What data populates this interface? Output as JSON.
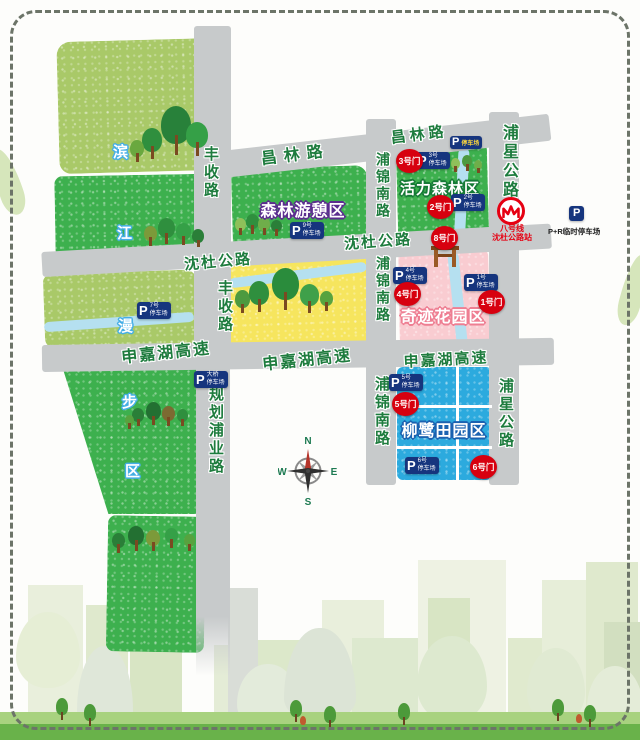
{
  "map": {
    "roads": {
      "fengshou": "丰收路",
      "changlin": "昌林路",
      "shendu": "沈杜公路",
      "shenjiahu": "申嘉湖高速",
      "pujin_south": "浦锦南路",
      "puxing": "浦星公路",
      "guihua_puye": "规划浦业路"
    },
    "zones": {
      "forest_leisure": "森林游憩区",
      "vital_forest": "活力森林区",
      "miracle_garden": "奇迹花园区",
      "willow_field": "柳鹭田园区"
    },
    "zone_chars": {
      "c1": "滨",
      "c2": "江",
      "c3": "漫",
      "c4": "步",
      "c5": "区"
    },
    "gates": {
      "g1": "1号门",
      "g2": "2号门",
      "g3": "3号门",
      "g4": "4号门",
      "g5": "5号门",
      "g6": "6号门",
      "g8": "8号门"
    },
    "parking": {
      "p": "P",
      "lot1": {
        "line1": "1号",
        "line2": "停车场"
      },
      "lot2": {
        "line1": "2号",
        "line2": "停车场"
      },
      "lot3": {
        "line1": "3号",
        "line2": "停车场"
      },
      "lot4": {
        "line1": "4号",
        "line2": "停车场"
      },
      "lot5": {
        "line1": "5号",
        "line2": "停车场"
      },
      "lot6": {
        "line1": "6号",
        "line2": "停车场"
      },
      "lot7": {
        "line1": "7号",
        "line2": "停车场"
      },
      "lot9": {
        "line1": "9号",
        "line2": "停车场"
      },
      "bridge": {
        "line1": "大桥",
        "line2": "停车场"
      },
      "roadside_label": "停车场",
      "park_and_ride": "P+R临时停车场"
    },
    "metro": {
      "line": "八号线",
      "station": "沈杜公路站"
    },
    "compass": {
      "n": "N",
      "e": "E",
      "s": "S",
      "w": "W"
    }
  }
}
